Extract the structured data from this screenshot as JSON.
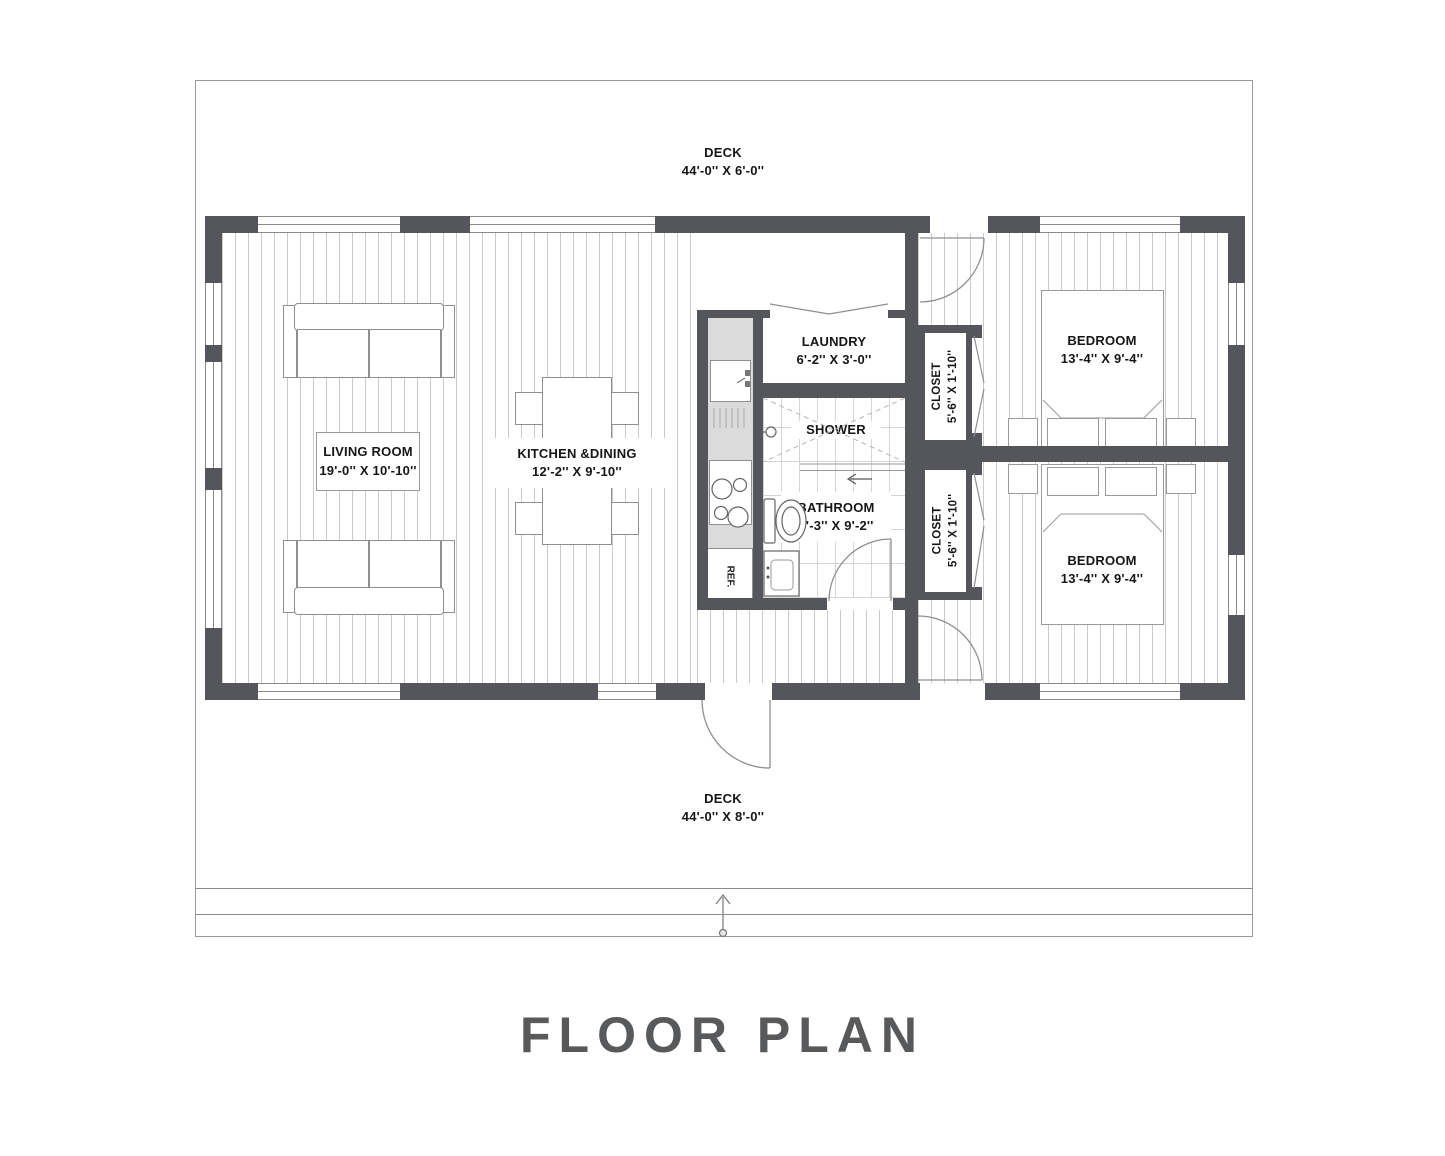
{
  "title": "FLOOR PLAN",
  "colors": {
    "wall": "#55565b",
    "line": "#8a8a8a",
    "plank": "#cbcbcb",
    "tile": "#d4d4d4",
    "counter": "#dbdbdb",
    "title_color": "#58595b",
    "text": "#161616"
  },
  "deck_top": {
    "name": "DECK",
    "dims": "44'-0'' X 6'-0''"
  },
  "deck_bottom": {
    "name": "DECK",
    "dims": "44'-0'' X 8'-0''"
  },
  "living_room": {
    "name": "LIVING ROOM",
    "dims": "19'-0'' X 10'-10''"
  },
  "kitchen_dining": {
    "name": "KITCHEN &DINING",
    "dims": "12'-2'' X 9'-10''"
  },
  "laundry": {
    "name": "LAUNDRY",
    "dims": "6'-2'' X 3'-0''"
  },
  "shower": {
    "name": "SHOWER"
  },
  "bathroom": {
    "name": "BATHROOM",
    "dims": "6'-3'' X 9'-2''"
  },
  "closet_top": {
    "name": "CLOSET",
    "dims": "5'-6'' X 1'-10''"
  },
  "closet_bottom": {
    "name": "CLOSET",
    "dims": "5'-6'' X 1'-10''"
  },
  "bedroom_top": {
    "name": "BEDROOM",
    "dims": "13'-4'' X 9'-4''"
  },
  "bedroom_bottom": {
    "name": "BEDROOM",
    "dims": "13'-4'' X 9'-4''"
  },
  "refrigerator": {
    "label": "REF."
  }
}
